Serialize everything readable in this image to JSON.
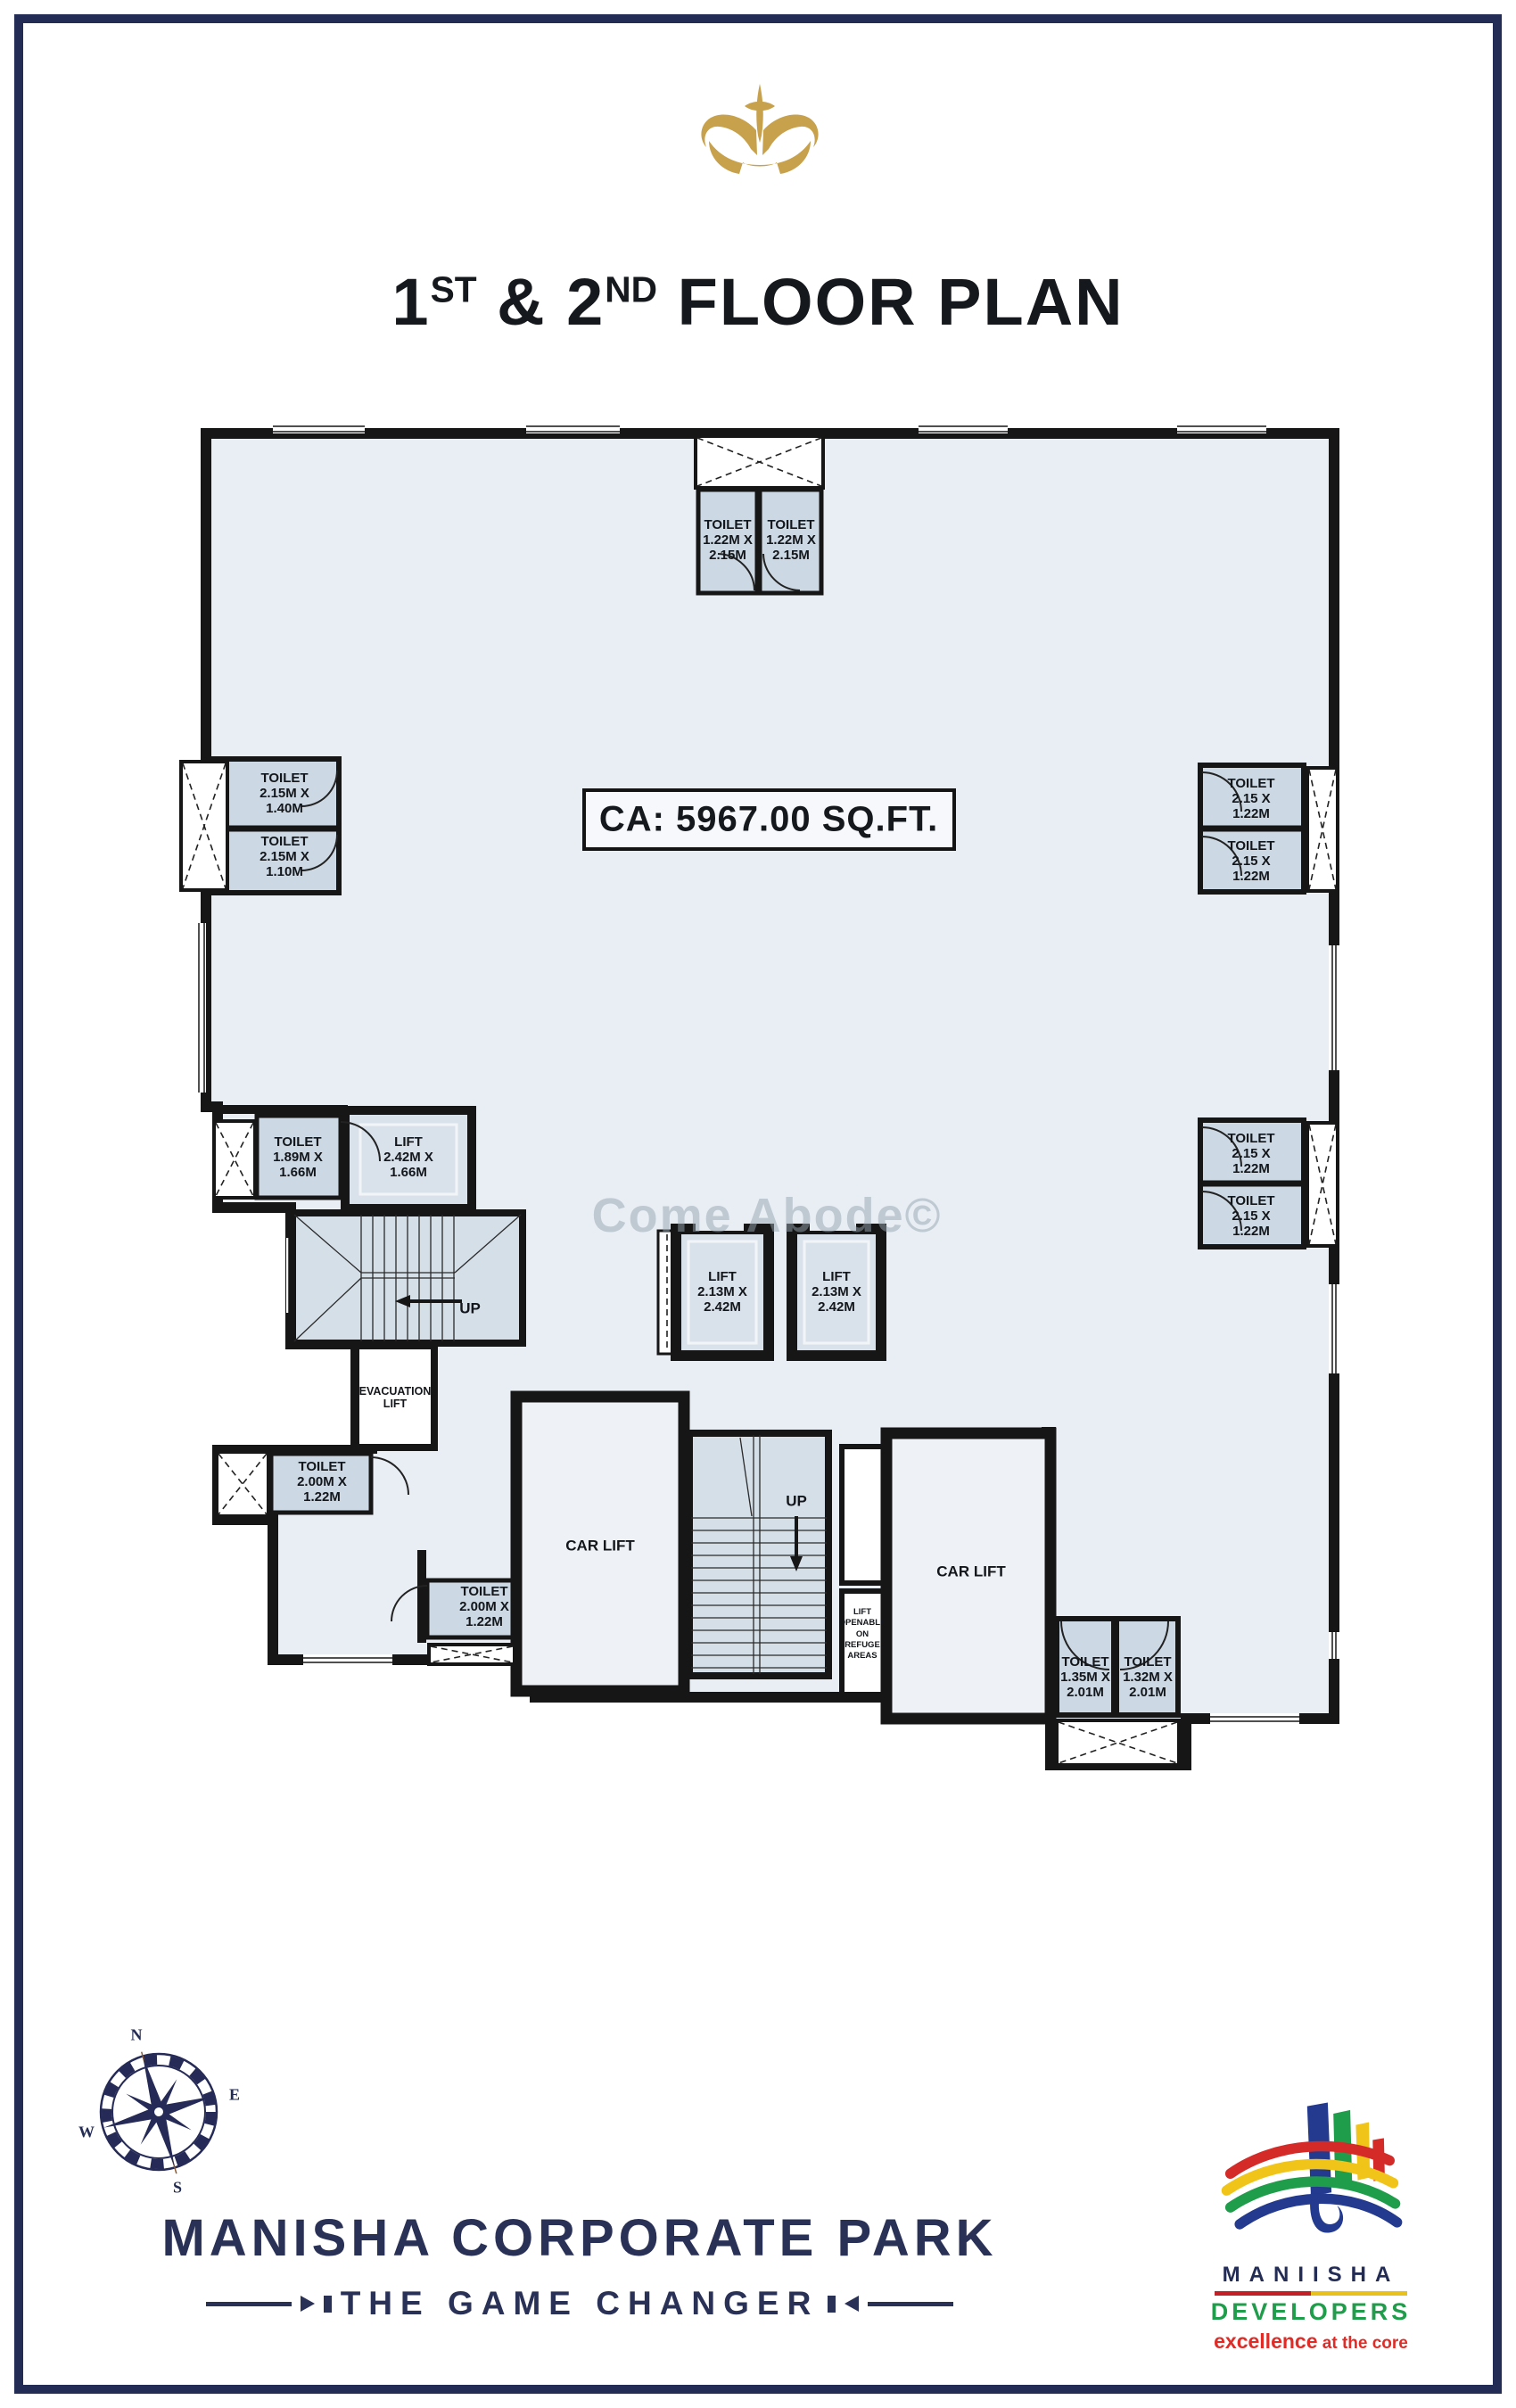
{
  "header": {
    "crown_icon": "crown-icon",
    "title": {
      "n1": "1",
      "s1": "ST",
      "mid": " & ",
      "n2": "2",
      "s2": "ND",
      "tail": " FLOOR PLAN"
    }
  },
  "plan": {
    "area_label": "CA: 5967.00 SQ.FT.",
    "watermark": "Come Abode©",
    "rooms": {
      "toilet_top_left": "TOILET\n1.22M X\n2.15M",
      "toilet_top_right": "TOILET\n1.22M X\n2.15M",
      "toilet_left_upper": "TOILET\n2.15M X\n1.40M",
      "toilet_left_lower": "TOILET\n2.15M X\n1.10M",
      "toilet_right_top_1": "TOILET\n2.15 X\n1.22M",
      "toilet_right_top_2": "TOILET\n2.15 X\n1.22M",
      "toilet_right_mid_1": "TOILET\n2.15 X\n1.22M",
      "toilet_right_mid_2": "TOILET\n2.15 X\n1.22M",
      "toilet_189": "TOILET\n1.89M X\n1.66M",
      "lift_242": "LIFT\n2.42M X\n1.66M",
      "lift_center_1": "LIFT\n2.13M X\n2.42M",
      "lift_center_2": "LIFT\n2.13M X\n2.42M",
      "evacuation_lift": "EVACUATION\nLIFT",
      "toilet_200_upper": "TOILET\n2.00M X\n1.22M",
      "toilet_200_lower": "TOILET\n2.00M X\n1.22M",
      "car_lift_left": "CAR LIFT",
      "car_lift_right": "CAR LIFT",
      "refuge_lift": "LIFT\nOPENABLE\nON\nREFUGE\nAREAS",
      "toilet_135": "TOILET\n1.35M X\n2.01M",
      "toilet_132": "TOILET\n1.32M X\n2.01M",
      "stair_up_1": "UP",
      "stair_up_2": "UP"
    }
  },
  "compass": {
    "icon": "compass-rose-icon",
    "n": "N",
    "e": "E",
    "s": "S",
    "w": "W"
  },
  "footer": {
    "project_name": "MANISHA CORPORATE PARK",
    "tagline": "THE GAME CHANGER"
  },
  "developer": {
    "logo_icon": "maniisha-developers-logo",
    "name": "MANIISHA",
    "category": "DEVELOPERS",
    "slogan_emphasis": "excellence",
    "slogan_rest": " at the core"
  },
  "colors": {
    "navy": "#232c54",
    "gold": "#c7a14b",
    "floor": "#e9eef4",
    "room_fill": "#ccd8e3",
    "wall": "#161616",
    "red": "#d52b28",
    "yellow": "#f0c419",
    "green": "#1f9d4b",
    "blue": "#233a8f",
    "slogan_red": "#e02b26"
  }
}
